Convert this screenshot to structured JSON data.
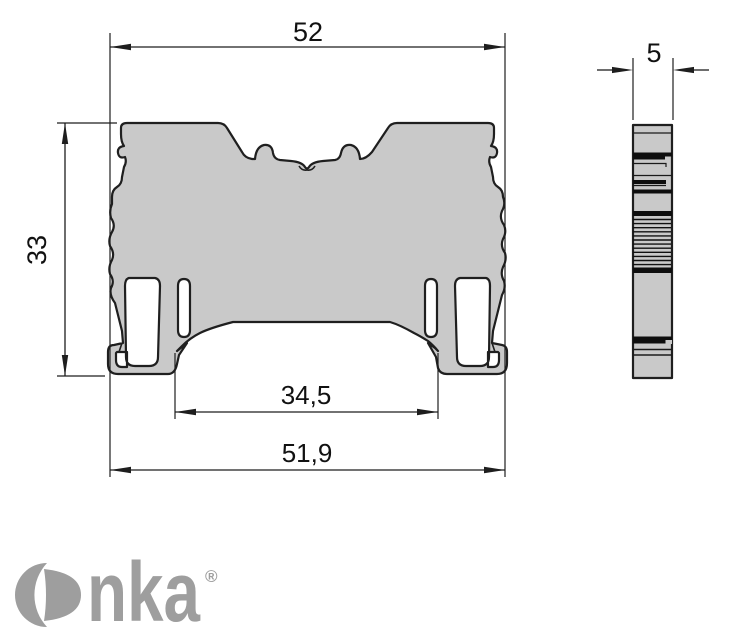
{
  "colors": {
    "background": "#ffffff",
    "outline": "#1f1f1f",
    "body_fill": "#c9c9c9",
    "detail_black": "#0e0e0e",
    "logo_gray": "#9e9e9e"
  },
  "dimensions": {
    "width_top": "52",
    "height_left": "33",
    "inner_width": "34,5",
    "width_bottom": "51,9",
    "side_thickness": "5"
  },
  "logo": {
    "name": "Onka",
    "letters": "nka",
    "registered": "®"
  }
}
